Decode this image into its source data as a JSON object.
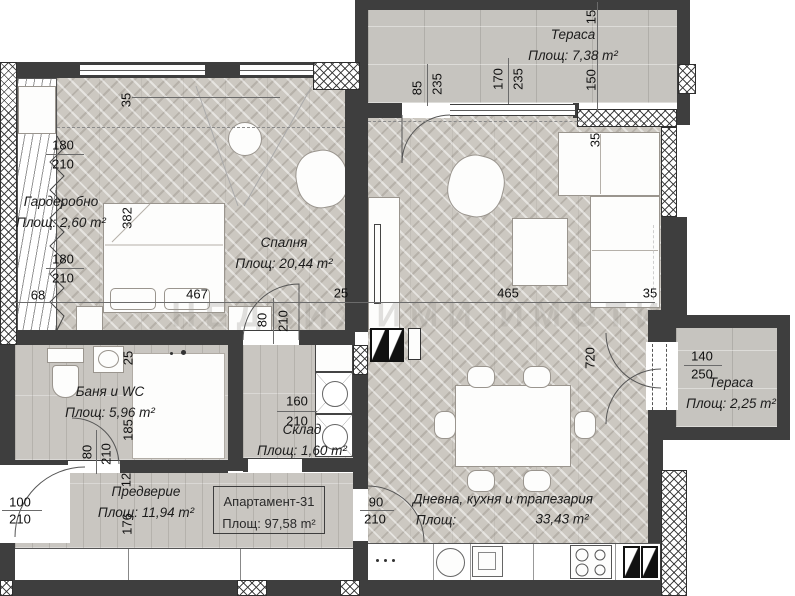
{
  "plan": {
    "watermark": "НЕДВИЖИМИ ИМОТИ",
    "apartment_box": {
      "title": "Апартамент-31",
      "area": "Площ: 97,58 m²"
    },
    "rooms": {
      "terrace_top": {
        "name": "Тераса",
        "area": "Площ: 7,38 m²"
      },
      "wardrobe": {
        "name": "Гардеробно",
        "area": "Площ: 2,60 m²"
      },
      "bedroom": {
        "name": "Спалня",
        "area": "Площ: 20,44 m²"
      },
      "bathroom": {
        "name": "Баня и WC",
        "area": "Площ: 5,96 m²"
      },
      "storage": {
        "name": "Склад",
        "area": "Площ: 1,60 m²"
      },
      "hallway": {
        "name": "Предверие",
        "area": "Площ: 11,94 m²"
      },
      "living": {
        "name": "Дневна, кухня и трапезария",
        "area_label": "Площ:",
        "area_value": "33,43 m²"
      },
      "terrace_right": {
        "name": "Тераса",
        "area": "Площ: 2,25 m²"
      }
    },
    "dimensions": [
      {
        "t": "15",
        "x": 591,
        "y": 17,
        "v": 1
      },
      {
        "t": "150",
        "x": 591,
        "y": 80,
        "v": 1
      },
      {
        "t": "85",
        "x": 417,
        "y": 88,
        "v": 1
      },
      {
        "t": "235",
        "x": 437,
        "y": 84,
        "v": 1
      },
      {
        "t": "170",
        "x": 498,
        "y": 79,
        "v": 1
      },
      {
        "t": "235",
        "x": 518,
        "y": 79,
        "v": 1
      },
      {
        "t": "35",
        "x": 126,
        "y": 100,
        "v": 1
      },
      {
        "t": "180",
        "x": 63,
        "y": 145
      },
      {
        "t": "210",
        "x": 63,
        "y": 164
      },
      {
        "t": "180",
        "x": 63,
        "y": 259
      },
      {
        "t": "210",
        "x": 63,
        "y": 278
      },
      {
        "t": "68",
        "x": 38,
        "y": 295
      },
      {
        "t": "382",
        "x": 127,
        "y": 218,
        "v": 1
      },
      {
        "t": "467",
        "x": 197,
        "y": 294
      },
      {
        "t": "25",
        "x": 341,
        "y": 293
      },
      {
        "t": "80",
        "x": 262,
        "y": 320,
        "v": 1
      },
      {
        "t": "210",
        "x": 283,
        "y": 321,
        "v": 1
      },
      {
        "t": "465",
        "x": 508,
        "y": 293
      },
      {
        "t": "35",
        "x": 650,
        "y": 293
      },
      {
        "t": "35",
        "x": 595,
        "y": 140,
        "v": 1
      },
      {
        "t": "720",
        "x": 590,
        "y": 358,
        "v": 1
      },
      {
        "t": "25",
        "x": 128,
        "y": 358,
        "v": 1
      },
      {
        "t": "185",
        "x": 128,
        "y": 430,
        "v": 1
      },
      {
        "t": "80",
        "x": 87,
        "y": 452,
        "v": 1
      },
      {
        "t": "210",
        "x": 106,
        "y": 454,
        "v": 1
      },
      {
        "t": "12",
        "x": 126,
        "y": 480,
        "v": 1
      },
      {
        "t": "160",
        "x": 297,
        "y": 401
      },
      {
        "t": "210",
        "x": 297,
        "y": 421
      },
      {
        "t": "100",
        "x": 20,
        "y": 502
      },
      {
        "t": "210",
        "x": 20,
        "y": 519
      },
      {
        "t": "176",
        "x": 127,
        "y": 524,
        "v": 1
      },
      {
        "t": "90",
        "x": 376,
        "y": 502
      },
      {
        "t": "210",
        "x": 375,
        "y": 519
      },
      {
        "t": "140",
        "x": 702,
        "y": 356
      },
      {
        "t": "250",
        "x": 702,
        "y": 374
      }
    ]
  }
}
